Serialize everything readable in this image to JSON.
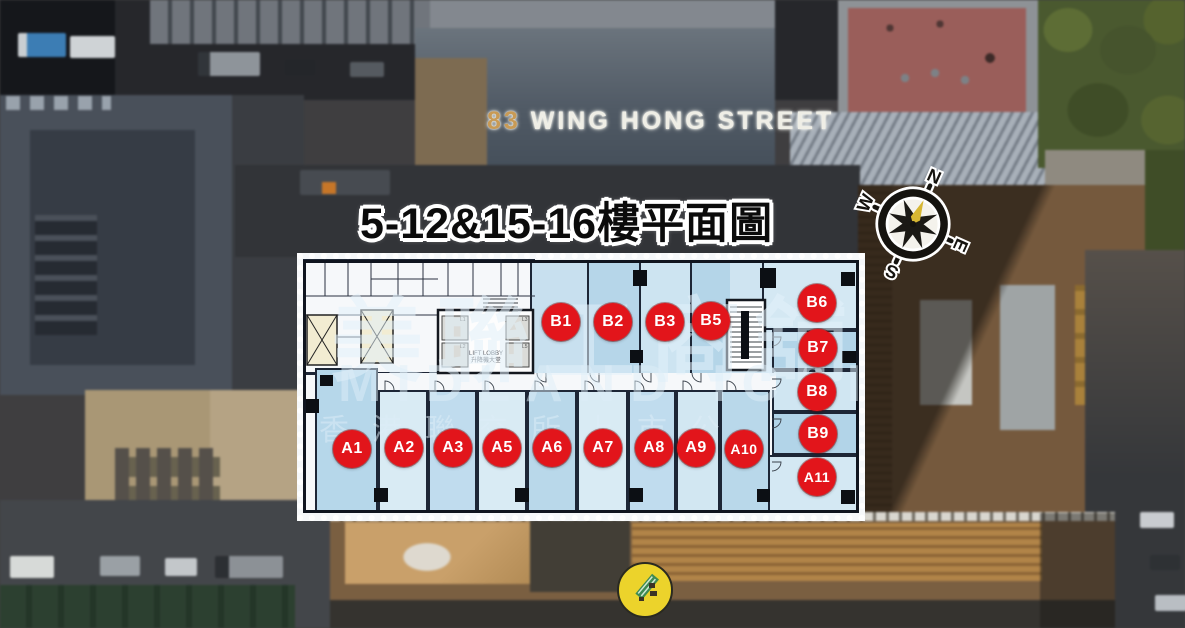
{
  "title": "5-12&15-16樓平面圖",
  "building_sign": {
    "number": "83",
    "street": "WING HONG STREET"
  },
  "compass": {
    "north": "N",
    "east": "E",
    "south": "S",
    "west": "W"
  },
  "watermark": {
    "brand_zh": "美聯工商舖",
    "brand_en": "MIDLAND IC&I",
    "listing_zh": "香港聯交所上市公"
  },
  "floorplan": {
    "lift_lobby": {
      "label_en": "LIFT LOBBY",
      "label_zh": "升降機大堂",
      "lifts": [
        "L1",
        "L2",
        "L3",
        "L5"
      ]
    },
    "units_b": [
      "B1",
      "B2",
      "B3",
      "B5"
    ],
    "units_right": [
      "B6",
      "B7",
      "B8",
      "B9",
      "A11"
    ],
    "units_a": [
      "A1",
      "A2",
      "A3",
      "A5",
      "A6",
      "A7",
      "A8",
      "A9",
      "A10"
    ]
  },
  "palette": {
    "badge_red": "#e2151b",
    "unit_light": "#d6e9f4",
    "unit_dark": "#b5d7ea",
    "plan_white": "#f6f8fa",
    "marker_yellow": "#ecd32b",
    "compass_gold": "#d7b733"
  }
}
